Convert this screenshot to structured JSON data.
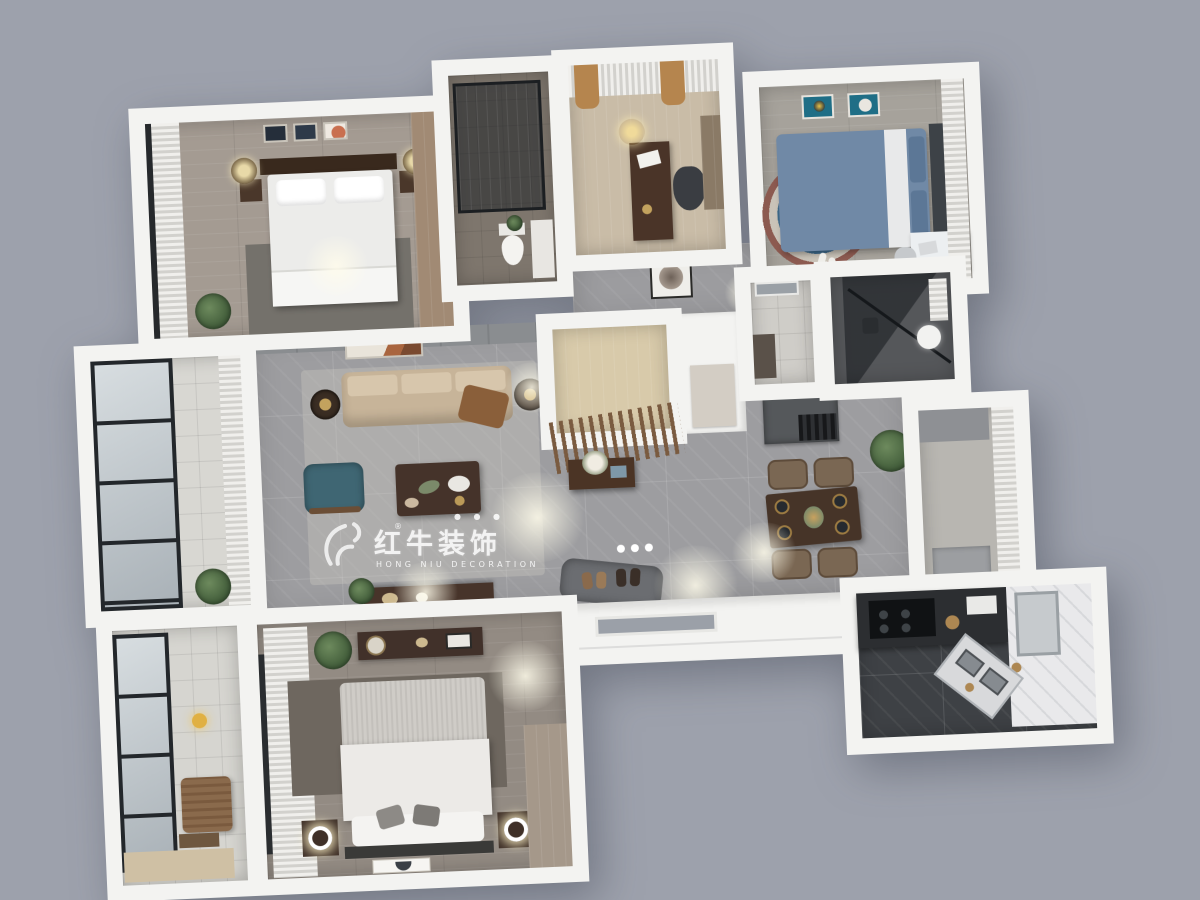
{
  "scene": {
    "type": "3d-floorplan-render",
    "description": "Top-down 3D render of a three-bedroom apartment interior",
    "background_color": "#9da1ac"
  },
  "watermark": {
    "logo": "hongniu-bull-logo",
    "registered": "®",
    "brand_cn": "红牛装饰",
    "dots": "● ● ●",
    "brand_en": "HONG NIU DECORATION",
    "color": "#ffffff"
  },
  "palette": {
    "background": "#9da1ac",
    "walls": "#f3f3f1",
    "marble_floor": "#9d9da0",
    "wood_floor": "#a49b92",
    "dark_wood": "#47342a",
    "sofa_beige": "#c7b499",
    "teal_armchair": "#3f6673",
    "kids_bed_blue": "#7089a6",
    "kitchen_floor": "#3e4145",
    "balcony_tile": "#d8d7d2",
    "curtain_white": "#e8e7e3",
    "drape_gold": "#b5854e",
    "plant_green": "#4c663f",
    "rug_gray": "#6e675f"
  },
  "rooms": [
    {
      "id": "second-bedroom",
      "area": "top-left",
      "furniture": [
        "double-bed",
        "dark-headboard",
        "wall-art-triptych",
        "nightstands",
        "table-lamps",
        "wardrobe",
        "rug",
        "floor-plant",
        "sheer-curtains",
        "window"
      ]
    },
    {
      "id": "bathroom",
      "area": "top-center",
      "furniture": [
        "glass-shower",
        "toilet",
        "vanity"
      ]
    },
    {
      "id": "study",
      "area": "top-center",
      "furniture": [
        "desk",
        "office-chair",
        "gold-drapes",
        "sheer-curtain",
        "chandelier",
        "shelf"
      ]
    },
    {
      "id": "kids-bedroom",
      "area": "top-right",
      "furniture": [
        "single-bed-blue",
        "wall-art-pair",
        "round-rug",
        "white-desk",
        "chair",
        "curtains",
        "slippers"
      ]
    },
    {
      "id": "laundry-room",
      "area": "mid-right",
      "furniture": [
        "window",
        "counter"
      ]
    },
    {
      "id": "shower-room",
      "area": "mid-right",
      "furniture": [
        "glass-screen",
        "rain-shower",
        "round-basin",
        "towel-blinds"
      ]
    },
    {
      "id": "hallway",
      "area": "center",
      "furniture": [
        "white-doors",
        "round-wall-art",
        "ceiling-lights"
      ]
    },
    {
      "id": "entry-foyer",
      "area": "center",
      "furniture": [
        "storage-closet",
        "wood-slat-screen",
        "console-table",
        "flower-arrangement",
        "doormat",
        "shoes",
        "entry-door"
      ]
    },
    {
      "id": "living-room",
      "area": "center-left",
      "furniture": [
        "three-seat-sofa",
        "back-cushions",
        "throw-blanket",
        "coffee-table",
        "teal-armchair",
        "round-side-tables",
        "tv-console",
        "area-rug",
        "wall-art",
        "media-wall"
      ]
    },
    {
      "id": "dining-area",
      "area": "center-right",
      "furniture": [
        "dining-table",
        "four-chairs",
        "place-settings",
        "dark-sideboard",
        "potted-plant"
      ]
    },
    {
      "id": "living-balcony",
      "area": "left",
      "furniture": [
        "floor-to-ceiling-windows",
        "sheer-curtain",
        "plant"
      ]
    },
    {
      "id": "laundry-balcony",
      "area": "bottom-left",
      "furniture": [
        "window",
        "lounge-chair",
        "magazine-rack",
        "yellow-floor-lamp",
        "wood-mat"
      ]
    },
    {
      "id": "master-bedroom",
      "area": "bottom",
      "furniture": [
        "king-bed",
        "textured-throw",
        "pillows",
        "dresser",
        "round-mirror",
        "nightstands",
        "ring-lamps",
        "wardrobe",
        "rug",
        "curtains",
        "fallen-art-frame",
        "plant"
      ]
    },
    {
      "id": "kitchen",
      "area": "bottom-right",
      "furniture": [
        "l-shaped-counter",
        "gas-hob",
        "double-sink",
        "fridge",
        "white-cabinets",
        "kettle"
      ]
    },
    {
      "id": "dining-balcony",
      "area": "right",
      "furniture": [
        "curtains",
        "cabinet",
        "bench"
      ]
    }
  ]
}
